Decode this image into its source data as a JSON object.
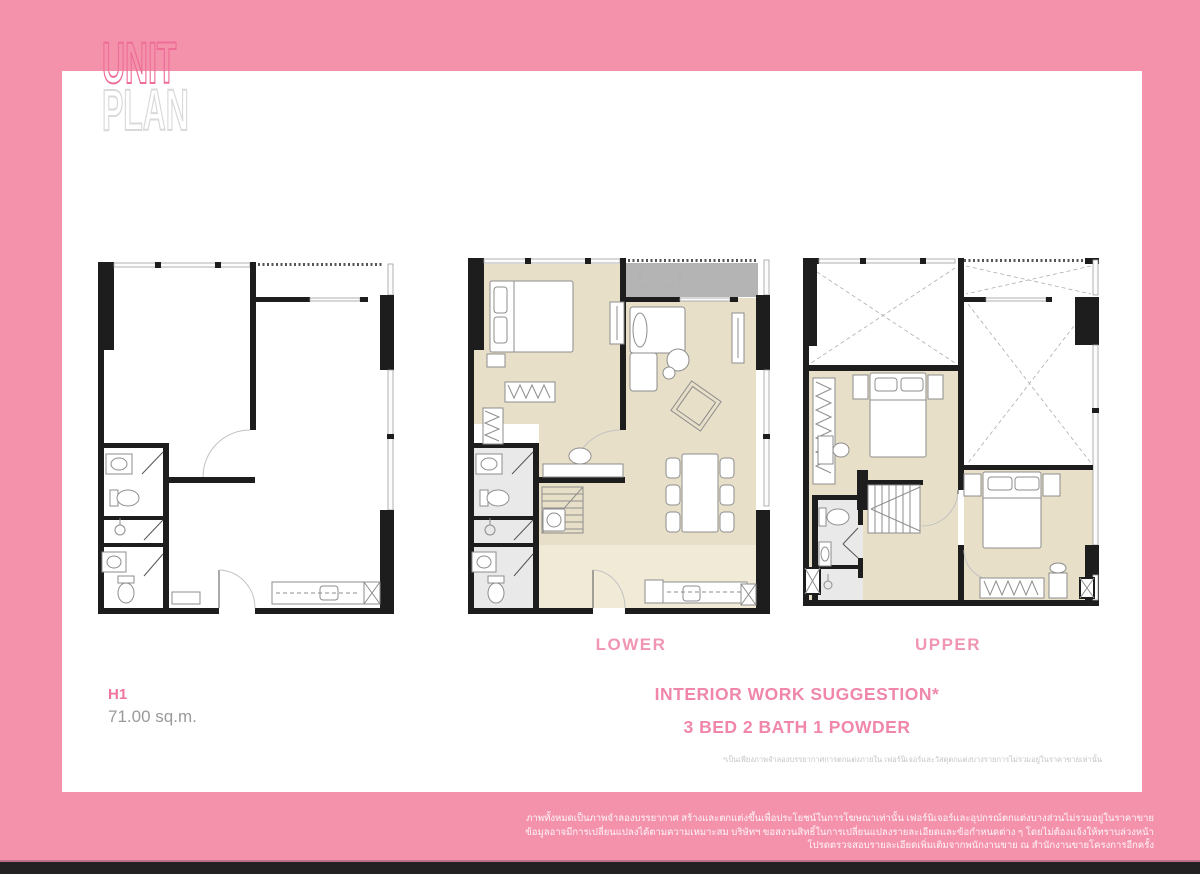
{
  "logo": {
    "line1": "UNIT",
    "line2": "PLAN"
  },
  "plans": [
    {
      "name": "unit-shell",
      "label": ""
    },
    {
      "name": "lower-floor",
      "label": "LOWER"
    },
    {
      "name": "upper-floor",
      "label": "UPPER"
    }
  ],
  "unit": {
    "code": "H1",
    "area": "71.00 sq.m."
  },
  "suggestion": {
    "line1": "INTERIOR WORK SUGGESTION*",
    "line2": "3 BED 2 BATH 1 POWDER"
  },
  "disclaimer": "*เป็นเพียงภาพจำลองบรรยากาศการตกแต่งภายใน เฟอร์นิเจอร์และวัสดุตกแต่งบางรายการไม่รวมอยู่ในราคาขายเท่านั้น",
  "footer": {
    "lines": [
      "ภาพทั้งหมดเป็นภาพจำลองบรรยากาศ สร้างและตกแต่งขึ้นเพื่อประโยชน์ในการโฆษณาเท่านั้น เฟอร์นิเจอร์และอุปกรณ์ตกแต่งบางส่วนไม่รวมอยู่ในราคาขาย",
      "ข้อมูลอาจมีการเปลี่ยนแปลงได้ตามความเหมาะสม บริษัทฯ ขอสงวนสิทธิ์ในการเปลี่ยนแปลงรายละเอียดและข้อกำหนดต่าง ๆ โดยไม่ต้องแจ้งให้ทราบล่วงหน้า",
      "โปรดตรวจสอบรายละเอียดเพิ่มเติมจากพนักงานขาย ณ สำนักงานขายโครงการอีกครั้ง"
    ]
  },
  "colors": {
    "frame_pink": "#f492ac",
    "accent_pink": "#f0749e",
    "label_pink": "#f095b2",
    "logo_pink_outline": "#ee6d97",
    "logo_gray_outline": "#d9d9d9",
    "floor_beige": "#e7dfc8",
    "floor_kitchen": "#f0ead6",
    "floor_bath": "#e9e9e9",
    "balcony_gray": "#b4b4b4",
    "wall_black": "#1d1d1d",
    "bottom_bar": "#242122"
  }
}
